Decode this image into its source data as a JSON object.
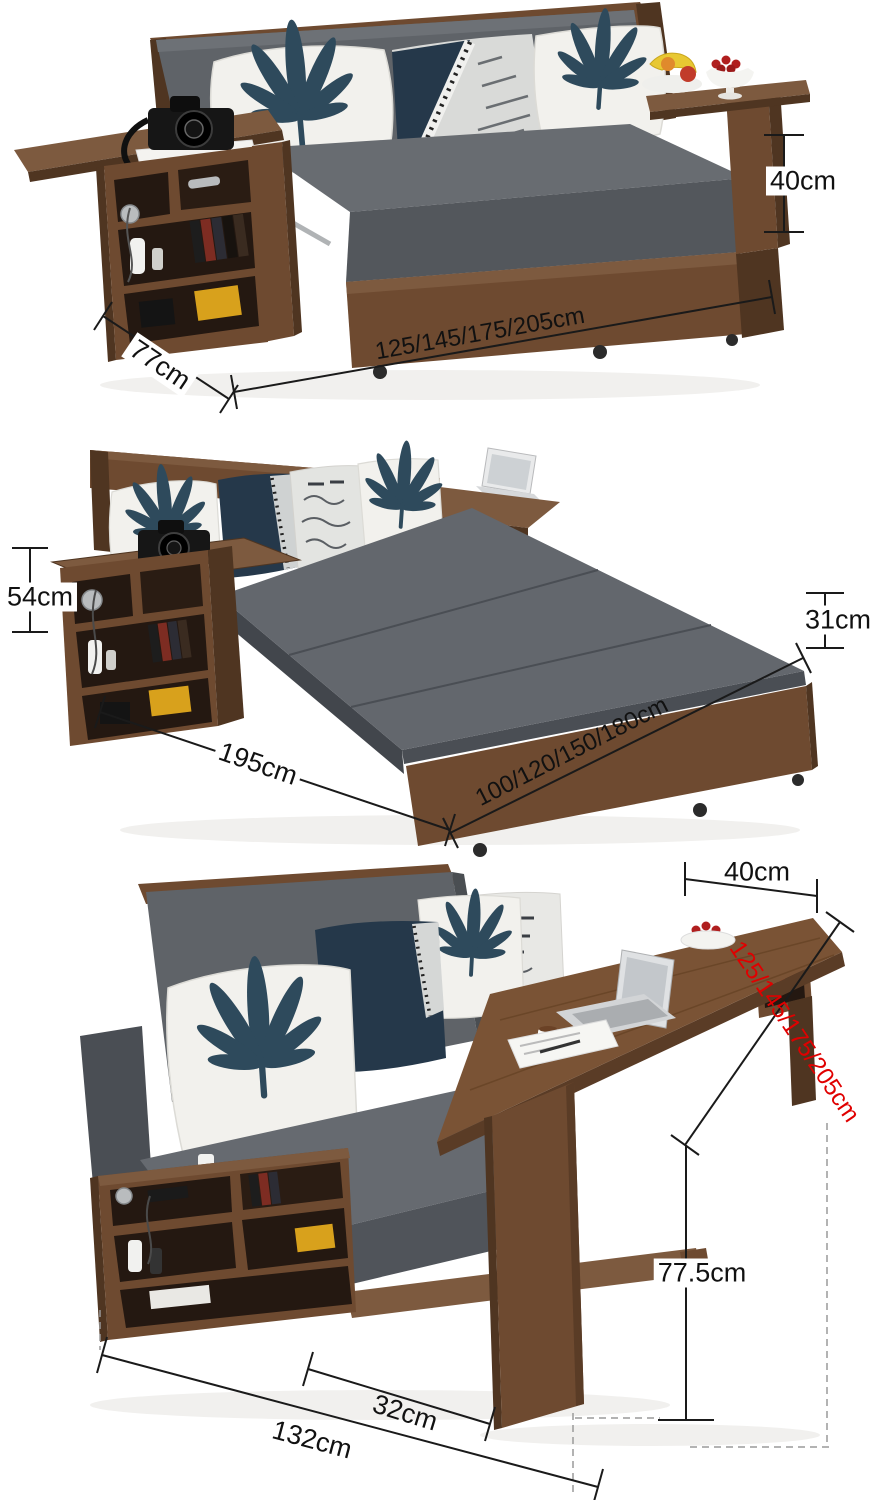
{
  "figure": {
    "description": "Convertible sofa bed product dimension diagram with three views: folded sofa, fold-out bed, and sofa with pull-out desk"
  },
  "colors": {
    "background": "#ffffff",
    "dimension_line": "#1a1a1a",
    "dimension_text": "#111111",
    "dimension_text_red": "#e00000",
    "wood_brown": "#6e4a30",
    "wood_light": "#7d5a3f",
    "wood_dark": "#4f3521",
    "fabric_gray": "#5d6166",
    "pillow_white": "#f2f1ed",
    "leaf_navy": "#2e4a5c",
    "cherry_red": "#b01f1f"
  },
  "sofa": {
    "dim_height": "40cm",
    "dim_depth": "77cm",
    "dim_width": "125/145/175/205cm"
  },
  "bed": {
    "dim_back_height": "54cm",
    "dim_side_height": "31cm",
    "dim_length": "195cm",
    "dim_width": "100/120/150/180cm"
  },
  "desk": {
    "dim_top_depth": "40cm",
    "dim_length": "125/145/175/205cm",
    "dim_height": "77.5cm",
    "dim_leg_offset": "32cm",
    "dim_total_width": "132cm"
  }
}
